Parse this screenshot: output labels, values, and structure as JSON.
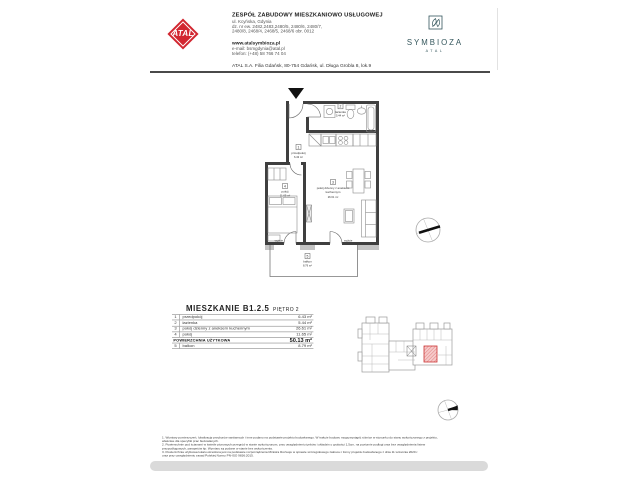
{
  "header": {
    "project_title": "ZESPÓŁ ZABUDOWY MIESZKANIOWO USŁUGOWEJ",
    "address_line1": "ul. Kcyńska, Gdynia",
    "address_line2": "dz. nr ew. 2482,2483,2480/5, 2480/6, 2480/7,",
    "address_line3": "2480/8, 2468/4, 2468/5, 2468/6  obr. 0012",
    "website": "www.atalsymbioza.pl",
    "email": "e-mail: bsmgdynia@atal.pl",
    "phone": "telefon: (+48) 58 766 74 04",
    "office": "ATAL S.A. Filia Gdańsk, 80-754 Gdańsk, ul. Długa Grobla 8, lok.9",
    "atal_logo_text": "ATAL",
    "brand_name": "SYMBIOZA",
    "brand_sub": "ATAL",
    "accent_red": "#d22630",
    "brand_color": "#34565c"
  },
  "plan": {
    "rooms": [
      {
        "num": "1",
        "line1": "przedpokój",
        "line2": "",
        "area": "6.43 m²"
      },
      {
        "num": "2",
        "line1": "łazienka",
        "line2": "",
        "area": "5.44 m²"
      },
      {
        "num": "3",
        "line1": "pokój dzienny z aneksem",
        "line2": "kuchennym",
        "area": "26.61 m²"
      },
      {
        "num": "4",
        "line1": "pokój",
        "line2": "",
        "area": "11.65 m²"
      },
      {
        "num": "5",
        "line1": "balkon",
        "line2": "",
        "area": "8.79 m²"
      }
    ],
    "door_label_left": "wyjście",
    "door_label_right": "wyjście"
  },
  "apartment": {
    "table_title": "MIESZKANIE  B1.2.5",
    "floor_label": "PIĘTRO 2",
    "rows": [
      {
        "no": "1",
        "name": "przedpokój",
        "area": "6.43 m²"
      },
      {
        "no": "2",
        "name": "łazienka",
        "area": "5.44 m²"
      },
      {
        "no": "3",
        "name": "pokój dzienny z aneksem kuchennym",
        "area": "26.61 m²"
      },
      {
        "no": "4",
        "name": "pokój",
        "area": "11.65 m²"
      }
    ],
    "total_label": "POWIERZCHNIA UŻYTKOWA",
    "total_area": "50.13 m²",
    "balcony_row": {
      "no": "5",
      "name": "balkon",
      "area": "8.79 m²"
    }
  },
  "footnotes": {
    "lines": [
      "1. Wymiary pomieszczeń, lokalizację przyborów sanitarnych i inne podano na podstawie projektu budowlanego. W trakcie budowy mogą wystąpić różnice w stosunku do stanu wykończonego z projektu,",
      "właściwe dla specyfiki prac budowlanych.",
      "2. Powierzchnie pod ścianami w świetle pionowych przegród w stanie wykończonym, przy uwzględnieniu tynków i okładzin o grubości 1,5cm, na poziomie podłogi oraz bez uwzględnienia listew",
      "przypodłogowych, parapetów itp. Wymiary są podane w stanie bez wykończenia.",
      "3. Powierzchnia użytkowa lokalu określona jest na podstawie rozporządzenia Ministra Rozwoju w sprawie szczegółowego zakresu i formy projektu budowlanego z dnia 11 września 2020 r.",
      "oraz przy uwzględnieniu zasad Polskiej Normy PN-ISO 9836:2015."
    ]
  }
}
